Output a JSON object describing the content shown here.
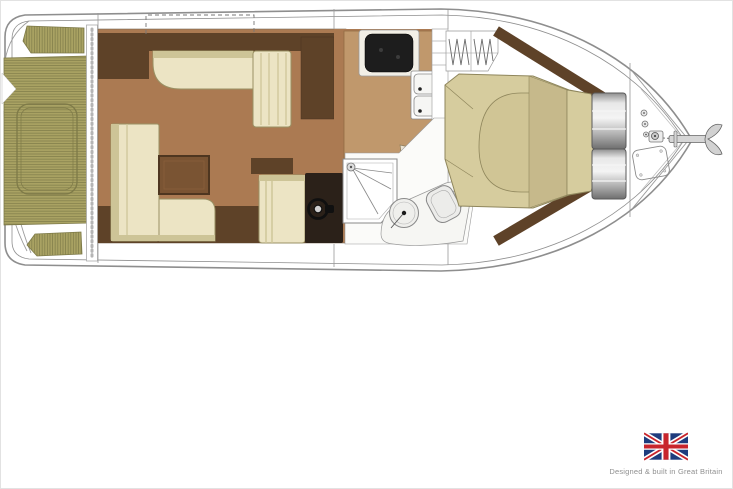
{
  "footer": {
    "caption": "Designed & built in Great Britain",
    "flag": "union-jack-flag"
  },
  "plan": {
    "type": "boat-floor-plan",
    "orientation": "bow-right",
    "features": [
      "swim-platform",
      "cockpit-teak-sole",
      "engine-hatch",
      "cockpit-bench-aft",
      "cockpit-bench-fwd",
      "patio-door-track",
      "saloon-settee",
      "saloon-chaise",
      "saloon-sofa",
      "saloon-table",
      "helm-seat",
      "helm-console",
      "steering-wheel",
      "galley-counter",
      "cooktop",
      "double-sink",
      "faucet",
      "head-door-swing",
      "shower-enclosure",
      "wash-basin",
      "toilet",
      "companionway-steps",
      "wardrobe-hangers",
      "island-bed",
      "mattress",
      "pillow-headboard",
      "storage-cylinders",
      "bow-deck-fittings",
      "anchor-windlass",
      "anchor-chain",
      "anchor",
      "anchor-locker-hatch",
      "sunroof-outline"
    ]
  },
  "colors": {
    "background": "#ffffff",
    "hullLine": "#8e8e8e",
    "deckLine": "#9c9c9c",
    "teak": "#a9a263",
    "teakStripe": "#7e7a48",
    "floor": "#ab7a52",
    "floorEdge": "#7a6a58",
    "counter": "#c0986c",
    "counterEdge": "#916b43",
    "darkWood": "#5e4228",
    "table": "#7a5433",
    "tableEdge": "#4e3620",
    "cream": "#ece4c4",
    "creamEdge": "#cdc497",
    "creamLine": "#9a9164",
    "khaki": "#d6cc9e",
    "khakiMid": "#d0c595",
    "khakiDark": "#c6b98b",
    "khakiLine": "#8f865c",
    "console": "#2b2119",
    "cooktop": "#1d1d1d",
    "fixtureFill": "#efefec",
    "fixtureLine": "#8a8a8a",
    "steelDark": "#6f6f6f",
    "flagBlue": "#1f3c7d",
    "flagRed": "#c8252c",
    "captionText": "#8f8f8f"
  }
}
